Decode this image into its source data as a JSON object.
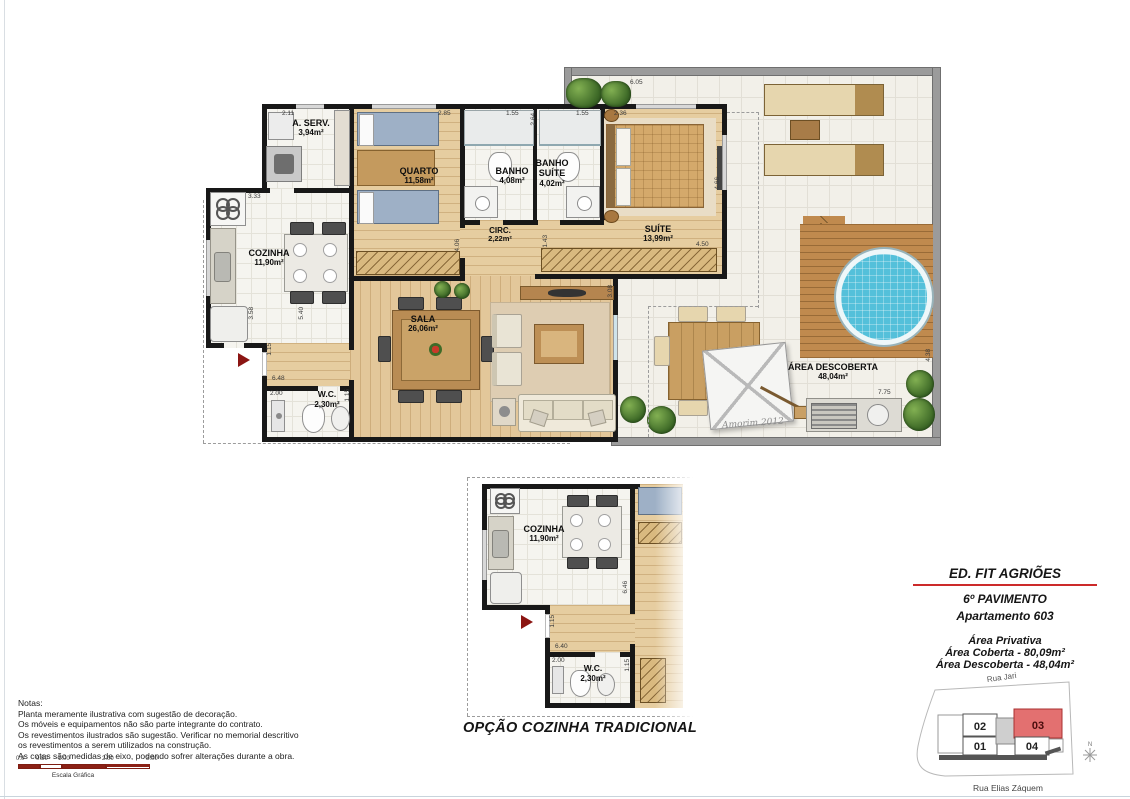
{
  "main_plan": {
    "rooms": [
      {
        "name": "A. SERV.",
        "area": "3,94m²"
      },
      {
        "name": "QUARTO",
        "area": "11,58m²"
      },
      {
        "name": "BANHO",
        "area": "4,08m²"
      },
      {
        "name": "BANHO SUÍTE",
        "area": "4,02m²"
      },
      {
        "name": "SUÍTE",
        "area": "13,99m²"
      },
      {
        "name": "CIRC.",
        "area": "2,22m²"
      },
      {
        "name": "COZINHA",
        "area": "11,90m²"
      },
      {
        "name": "SALA",
        "area": "26,06m²"
      },
      {
        "name": "W.C.",
        "area": "2,30m²"
      },
      {
        "name": "ÁREA DESCOBERTA",
        "area": "48,04m²"
      }
    ],
    "dims": [
      "2.11",
      "2.85",
      "1.55",
      "2.64",
      "1.55",
      "2.36",
      "6.05",
      "3.33",
      "4.06",
      "1.43",
      "4.66",
      "4.50",
      "3.08",
      "3.58",
      "5.40",
      "1.15",
      "6.48",
      "2.00",
      "1.15",
      "4.38",
      "7.75"
    ],
    "signature": "Amorim 2012"
  },
  "secondary_plan": {
    "caption": "OPÇÃO COZINHA TRADICIONAL",
    "rooms": [
      {
        "name": "COZINHA",
        "area": "11,90m²"
      },
      {
        "name": "W.C.",
        "area": "2,30m²"
      }
    ],
    "dims": [
      "6.46",
      "1.15",
      "6.40",
      "2.00",
      "1.15"
    ]
  },
  "notes": {
    "heading": "Notas:",
    "lines": [
      "Planta meramente ilustrativa com sugestão de decoração.",
      "Os móveis e equipamentos não são parte integrante do contrato.",
      "Os revestimentos ilustrados são sugestão. Verificar no memorial descritivo",
      "os revestimentos a serem utilizados na construção.",
      "As cotas são medidas de eixo, podendo sofrer alterações durante a obra."
    ]
  },
  "scale_bar": {
    "ticks": [
      "0.0",
      "0.50",
      "1.00",
      "2.00",
      "3.00"
    ],
    "label": "Escala Gráfica"
  },
  "title_block": {
    "building": "ED. FIT AGRIÕES",
    "floor": "6º PAVIMENTO",
    "apartment": "Apartamento 603",
    "private_label": "Área Privativa",
    "covered": "Área Coberta - 80,09m²",
    "uncovered": "Área Descoberta - 48,04m²"
  },
  "location_map": {
    "street_top": "Rua Jari",
    "street_bottom": "Rua Elias Záquem",
    "north": "N",
    "units": [
      {
        "id": "02"
      },
      {
        "id": "03",
        "highlighted": true
      },
      {
        "id": "01"
      },
      {
        "id": "04"
      }
    ]
  },
  "colors": {
    "unit_highlight": "#e37070",
    "scale_red": "#8b2015",
    "wall": "#181818",
    "title_rule": "#cc2a2a"
  }
}
